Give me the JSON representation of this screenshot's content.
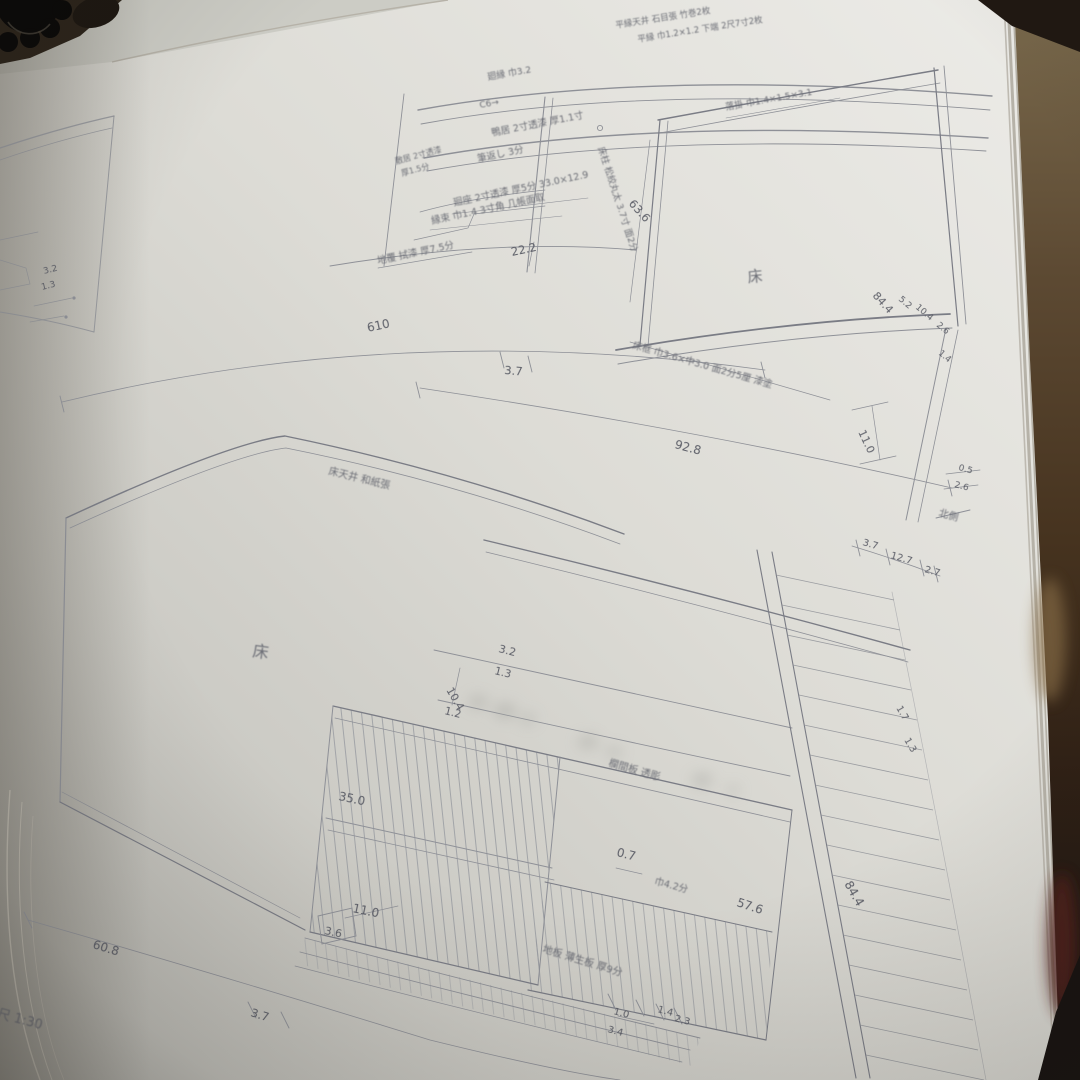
{
  "scene": {
    "type": "photograph of an open book page with Japanese architectural drawings (tokonoma alcove elevations)",
    "scale_note": "縮尺 1:30"
  },
  "colors": {
    "paper": "#dcdbd5",
    "pencil_line": "#8e9097",
    "ink_text": "#63656d",
    "cover_brown": "#5d4a33",
    "cover_dark": "#1c140e",
    "shadow_red": "#55231a"
  },
  "upper": {
    "header_line1": "平縁天井 石目張 竹巻2枚",
    "header_line2": "平縁 巾1.2×1.2 下端 2尺7寸2枚",
    "mawaribuchi": "廻縁 巾3.2",
    "c6": "C6→",
    "kamoi": "鴨居 2寸透漆 厚1.1寸",
    "shikii_1": "敷居 2寸透漆",
    "shikii_2": "厚1.5分",
    "fudegaeshi": "筆返し 3分",
    "mawashiza": "廻座 2寸透漆 厚5分 33.0×12.9",
    "entsuka": "縁束 巾1.4 3寸角 几帳面取",
    "jifuku": "地覆 拭漆 厚7.5分",
    "dim_22_2": "22.2",
    "tokobashira": "床柱 松絞丸太 3.7寸 面2分",
    "otoshigake": "落掛 巾1.4×1.5×3.1",
    "toko": "床",
    "dim_63_6": "63.6",
    "dim_84_4": "84.4",
    "dim_5_2": "5.2",
    "dim_10_4": "10.4",
    "dim_2_6_side": "2.6",
    "dim_1_4_side": "1.4",
    "tokogamachi": "床框 巾3.6×中3.0 面2分5厘 漆塗",
    "dim_610": "610",
    "dim_3_7": "3.7",
    "dim_92_8": "92.8",
    "dim_11_0": "11.0",
    "dim_0_5": "0.5",
    "dim_2_6": "2.6",
    "kitagawa": "北側",
    "dim_b_3_7": "3.7",
    "dim_b_12_7": "12.7",
    "dim_b_2_7": "2.7"
  },
  "lower": {
    "tokotenjo": "床天井 和紙張",
    "toko": "床",
    "dim_3_2": "3.2",
    "dim_1_3": "1.3",
    "dim_10_4": "10.4",
    "dim_1_2": "1.2",
    "ranma": "欄間板 透彫",
    "dim_35_0": "35.0",
    "dim_0_7": "0.7",
    "haba": "巾4.2分",
    "dim_57_6": "57.6",
    "dim_84_4": "84.4",
    "dim_11_0": "11.0",
    "dim_3_6": "3.6",
    "jiita": "地板 薄生板 厚9分",
    "dim_60_8": "60.8",
    "dim_3_7": "3.7",
    "dim_1_0": "1.0",
    "dim_3_4": "3.4",
    "dim_1_4": "1.4",
    "dim_2_3": "2.3",
    "dim_1_7": "1.7",
    "dim_1_3_r": "1.3",
    "scale": "縮尺 1:30"
  },
  "left_page": {
    "dim_3_2": "3.2",
    "dim_1_3": "1.3"
  }
}
